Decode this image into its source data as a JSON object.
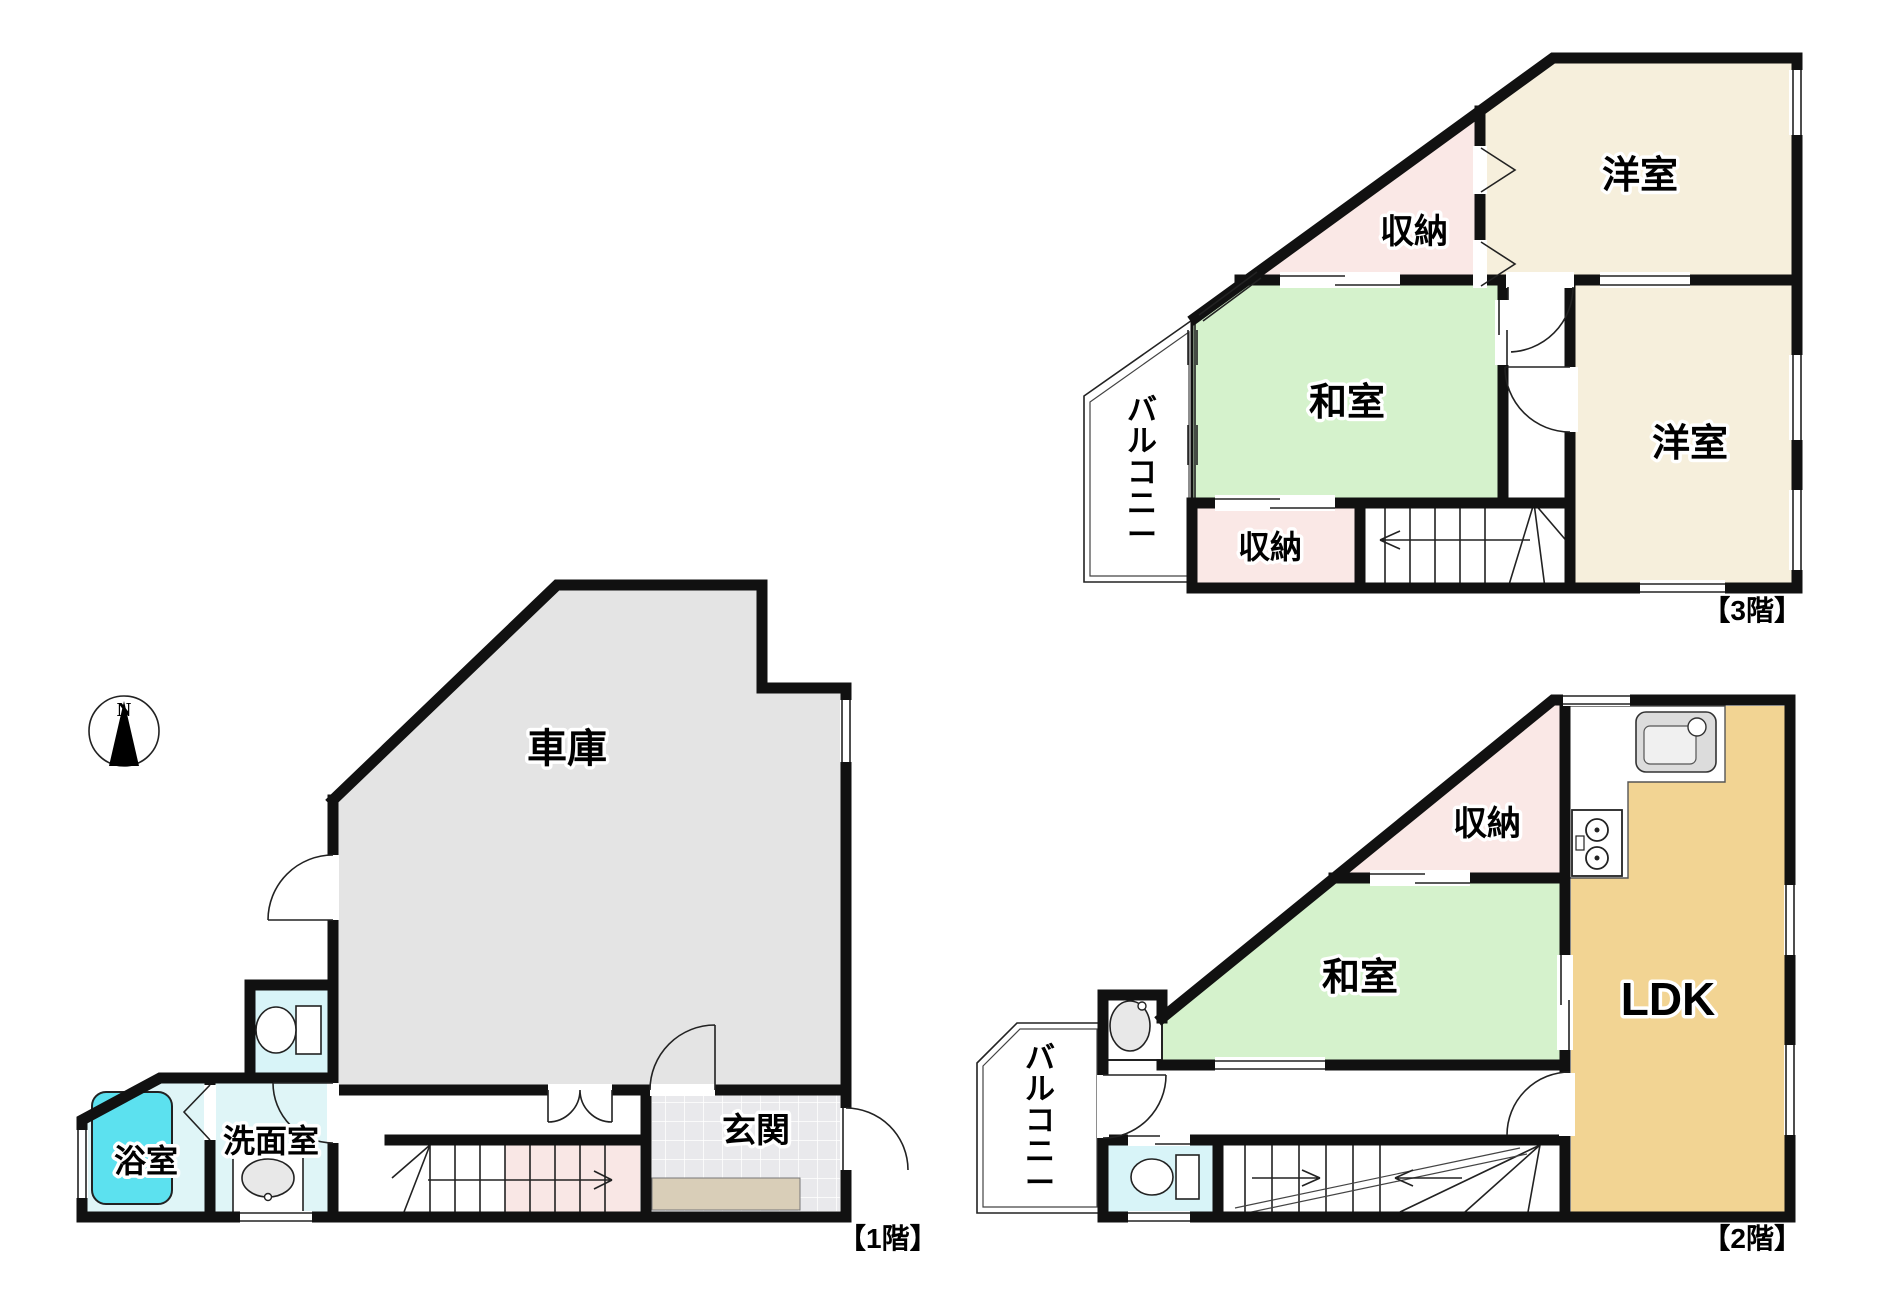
{
  "title": "間取り図（1階・2階・3階）",
  "compass": {
    "north_label": "N"
  },
  "floor3": {
    "floor_label": "【3階】",
    "rooms": {
      "yoshitsu_top": "洋室",
      "shuno_top": "収納",
      "washitsu": "和室",
      "yoshitsu_right": "洋室",
      "shuno_bottom": "収納",
      "balcony": "バルコニー"
    }
  },
  "floor2": {
    "floor_label": "【2階】",
    "rooms": {
      "shuno": "収納",
      "washitsu": "和室",
      "ldk": "LDK",
      "balcony": "バルコニー"
    }
  },
  "floor1": {
    "floor_label": "【1階】",
    "rooms": {
      "garage": "車庫",
      "bathroom": "浴室",
      "washroom": "洗面室",
      "entrance": "玄関"
    }
  },
  "colors": {
    "wall": "#111111",
    "western_room": "#F6EFDC",
    "japanese_room": "#D5F2CC",
    "storage": "#FAE8E6",
    "ldk": "#F2D493",
    "garage": "#E4E4E4",
    "wet_room": "#DFF5F7",
    "toilet_room": "#D8F4F8",
    "bathtub": "#5CE1EF",
    "entrance_tile": "#E9E9EC",
    "entrance_mat": "#D9CEB8",
    "stair_pink": "#F9E7E5"
  }
}
